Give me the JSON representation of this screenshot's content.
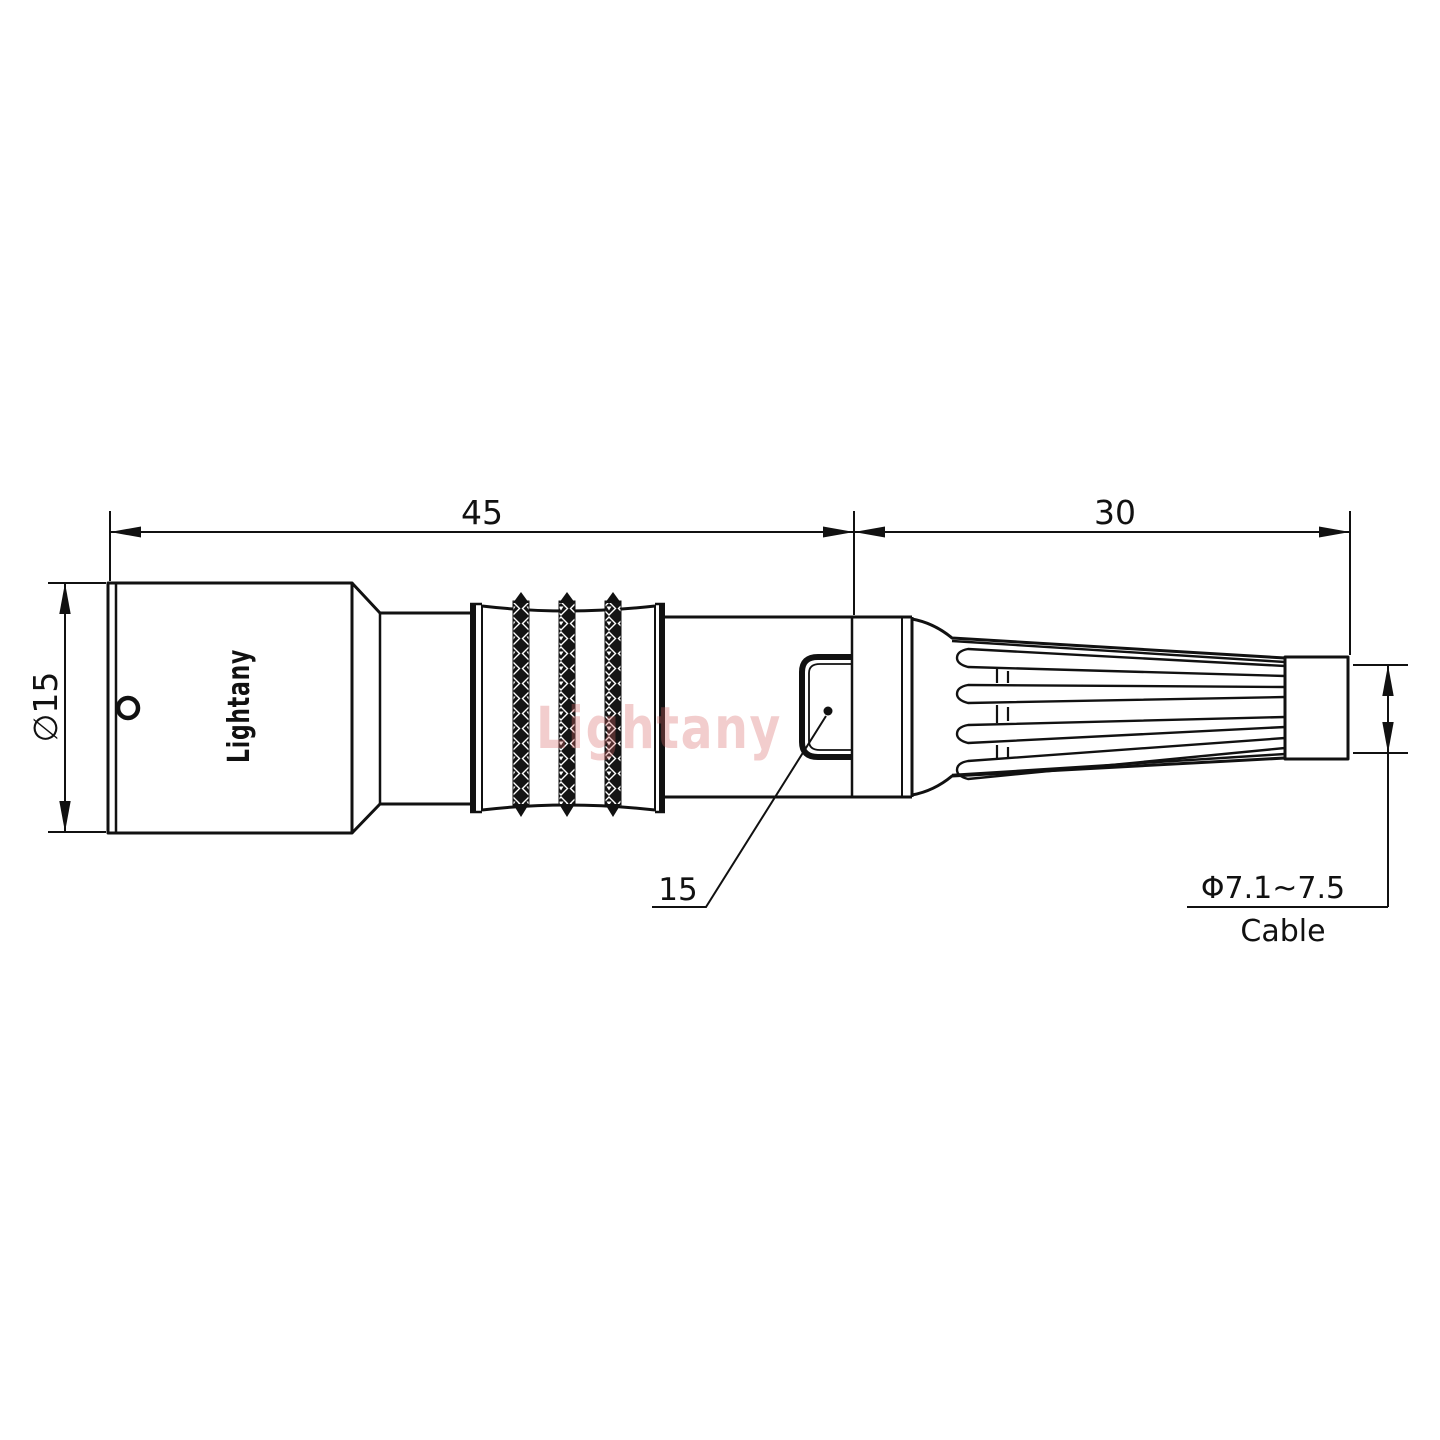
{
  "drawing": {
    "brand": "Lightany",
    "watermark": "Lightany",
    "dimensions": {
      "front_length": "45",
      "rear_length": "30",
      "shell_diameter": "∅15",
      "nut_leader": "15",
      "cable_diameter": "Φ7.1~7.5",
      "cable_label": "Cable"
    },
    "colors": {
      "line": "#111111",
      "watermark_pink": "#d96666"
    }
  }
}
